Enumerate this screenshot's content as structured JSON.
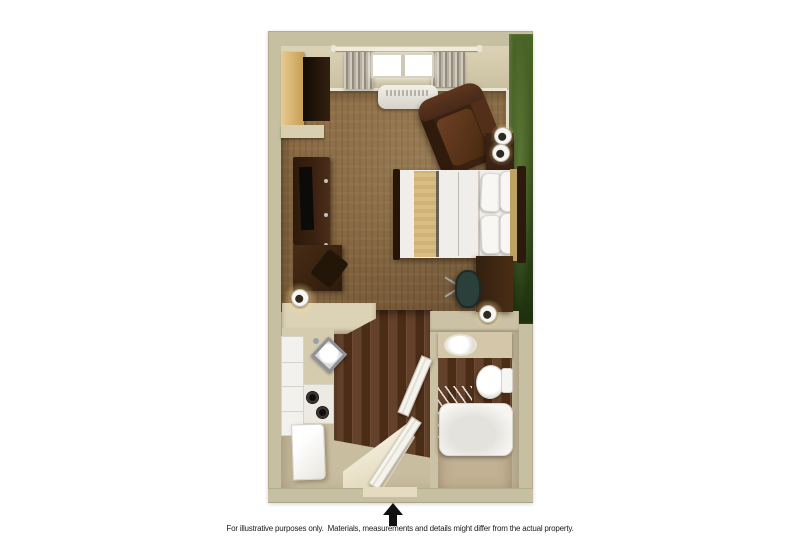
{
  "disclaimer": {
    "text": "For illustrative purposes only.  Materials, measurements and details might differ from the actual property."
  },
  "entrance": {
    "icon": "up-arrow",
    "position": "bottom-center"
  },
  "palette": {
    "wall": "#c6bfa1",
    "wall_face": "#dcd3b6",
    "trim": "#f0ead7",
    "carpet": "#84653f",
    "wood": "#4b2c17",
    "wood_light": "#64412a",
    "bath_wall": "#c2b193",
    "bath_floor": "#c9bda0",
    "green_light": "#4a6527",
    "green_mid": "#3c5520",
    "green_dark": "#1d2f0e",
    "counter": "#dcd2b6",
    "cabinet_white": "#f2f1ed",
    "furn_dark": "#3a2110",
    "bed_white": "#f0eeea",
    "runner": "#d9bd82",
    "headboard_tan": "#c0a265",
    "chair_teal": "#2b403b",
    "lamp_glow": "rgba(255,222,150,0.85)",
    "arrow_black": "#111111",
    "caption_color": "#1c1c1c"
  },
  "rooms": {
    "bedroom": {
      "fixtures": [
        "closet",
        "tv-console",
        "credenza",
        "dining-chair",
        "table-lamp",
        "window",
        "curtains",
        "hvac-unit",
        "armchair",
        "nightstand",
        "nightstand-lamps",
        "bed",
        "headboard",
        "desk",
        "office-chair",
        "desk-lamp"
      ]
    },
    "kitchen": {
      "fixtures": [
        "counter",
        "sink",
        "cabinets",
        "stove",
        "refrigerator"
      ]
    },
    "entry": {
      "fixtures": [
        "entry-door",
        "threshold"
      ]
    },
    "bathroom": {
      "fixtures": [
        "vanity",
        "vanity-sink",
        "toilet",
        "bathtub",
        "shower-curtain",
        "bathroom-door"
      ]
    }
  }
}
